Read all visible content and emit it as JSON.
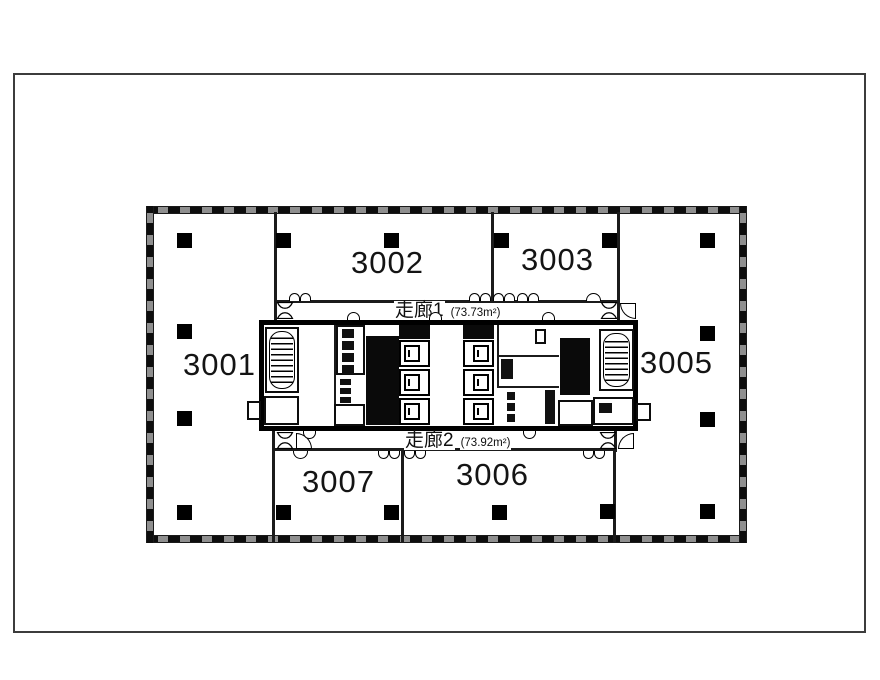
{
  "sheet": {
    "type": "floor-plan-drawing"
  },
  "rooms": [
    {
      "id": "3001",
      "label": "3001"
    },
    {
      "id": "3002",
      "label": "3002"
    },
    {
      "id": "3003",
      "label": "3003"
    },
    {
      "id": "3005",
      "label": "3005"
    },
    {
      "id": "3006",
      "label": "3006"
    },
    {
      "id": "3007",
      "label": "3007"
    }
  ],
  "corridors": [
    {
      "label": "走廊1",
      "area": "(73.73m²)"
    },
    {
      "label": "走廊2",
      "area": "(73.92m²)"
    }
  ],
  "colors": {
    "wall": "#1b1b1b",
    "column": "#000000",
    "hatch_gray": "#8f8f8f",
    "text": "#141414",
    "background": "#ffffff"
  }
}
